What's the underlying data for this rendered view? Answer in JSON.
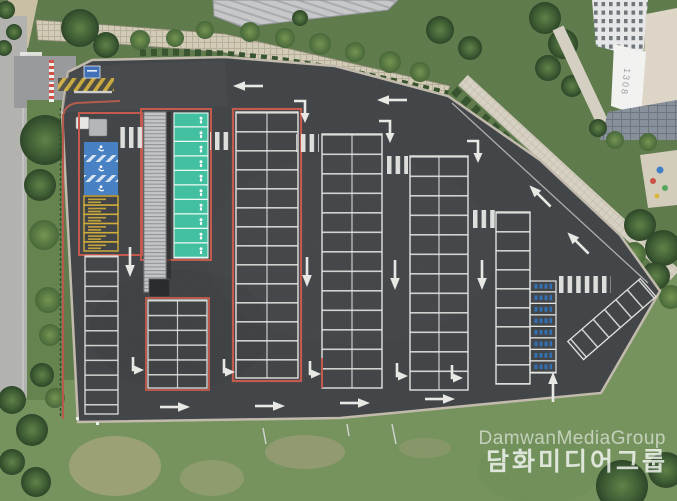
{
  "scene": {
    "description": "Aerial drone photo of a newly paved asphalt parking lot with painted stalls, crosswalks and lane arrows, beside a road, landscaped slope, apartment tower and grass field",
    "watermark": {
      "line1": "DamwanMediaGroup",
      "line2": "담화미디어그룹"
    },
    "building": {
      "label": "1308"
    },
    "stall_groups": {
      "accessible_blue_stalls": 3,
      "yellow_marked_stalls": 6,
      "teal_priority_stalls": 10,
      "blue_labeled_stalls": 8
    },
    "colors": {
      "asphalt": "#404346",
      "lane_line_white": "#e6e6e3",
      "curb_red": "#c4584a",
      "accessible_blue": "#4580c4",
      "priority_teal": "#3fc0a0",
      "stall_yellow": "#d2ae37",
      "ev_label_blue": "#2f6fb5",
      "grass_green": "#74925c",
      "dry_grass": "#a5a47b",
      "road_gray": "#b2b3af",
      "wall_tan": "#d3ccb7",
      "sidewalk": "#d8d2c4",
      "tree_dark": "#33502b",
      "building_white": "#ededee"
    }
  }
}
